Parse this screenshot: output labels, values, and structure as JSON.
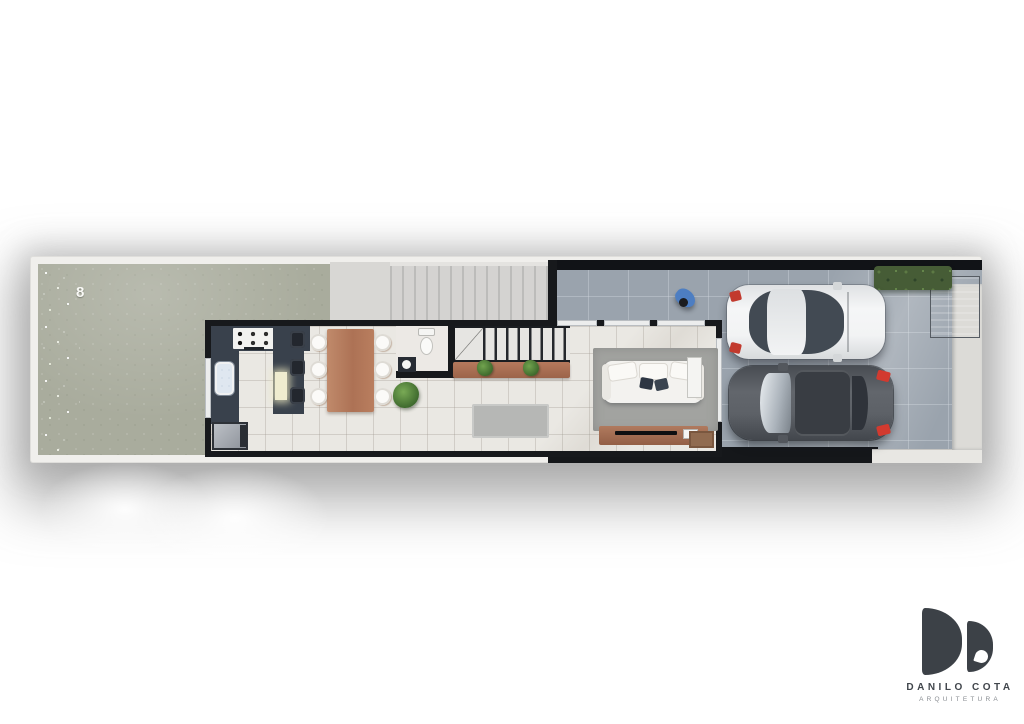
{
  "plan": {
    "lot_number_label": "8",
    "areas": [
      "backyard",
      "patio-slab",
      "pergola-deck",
      "kitchen",
      "dining-area",
      "bathroom",
      "staircase",
      "hallway",
      "living-room",
      "garage-driveway",
      "boundary-sidewalk"
    ],
    "objects": [
      "cooktop",
      "kitchen-sink",
      "kitchen-island",
      "bar-stools",
      "dining-table",
      "dining-chairs",
      "toilet",
      "bathroom-vanity",
      "stair-railing",
      "wood-sideboard",
      "potted-plants",
      "floor-plant",
      "hall-rug",
      "living-rug",
      "sofa",
      "throw-pillows",
      "side-cabinet",
      "tv-console",
      "tv",
      "doormat",
      "utility-cabinet",
      "hedge",
      "entry-gate",
      "person",
      "white-car",
      "dark-car"
    ]
  },
  "branding": {
    "studio_name": "DANILO COTA",
    "studio_tagline": "ARQUITETURA"
  },
  "colors": {
    "background": "#ffffff",
    "grass": "#a9ac9d",
    "marble_floor": "#eae8e3",
    "concrete_floor": "#9aa3ad",
    "walls": "#17191c",
    "counter": "#39414c",
    "wood": "#b5795d",
    "hedge": "#465c36",
    "person_shirt": "#4d7ec2",
    "taillight_red": "#c8352c",
    "logo_ink": "#3c4147"
  }
}
